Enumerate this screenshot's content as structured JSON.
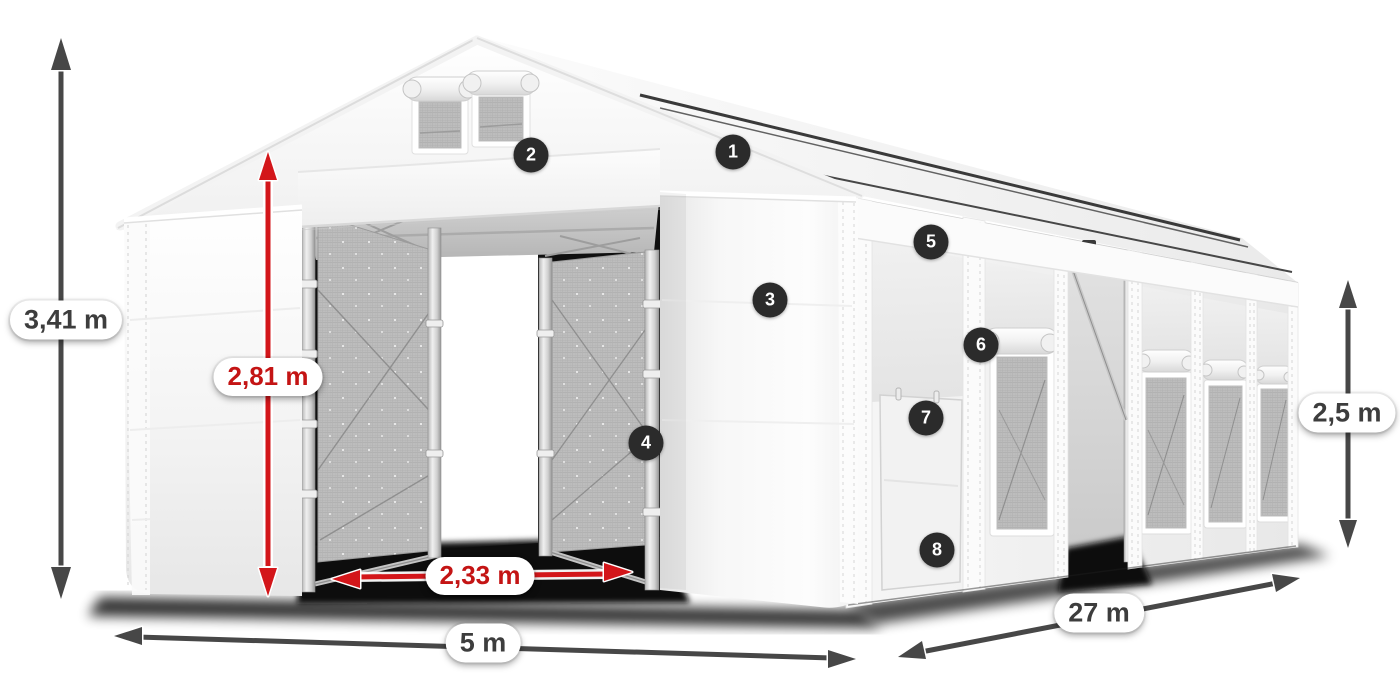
{
  "description": "Annotated product rendering of a white PVC storage tent (5 x 27 m) with open front gates, mesh side windows, a side entrance door, red and dark dimension arrows and eight numbered feature markers",
  "colors": {
    "background": "#ffffff",
    "arrow_dark": "#474747",
    "arrow_red": "#d3161a",
    "label_dark": "#3d3d3d",
    "label_red": "#c41414",
    "pill_bg": "#ffffff",
    "badge_bg": "#2b2b2b",
    "badge_text": "#ffffff",
    "tent_white": "#f7f7f7",
    "mesh_gray": "#bdbdbd",
    "interior_dark": "#101010"
  },
  "dimension_labels": {
    "total_height": "3,41 m",
    "door_height": "2,81 m",
    "door_width": "2,33 m",
    "front_width": "5 m",
    "side_length": "27 m",
    "side_wall_height": "2,5 m"
  },
  "feature_markers": [
    {
      "number": "1"
    },
    {
      "number": "2"
    },
    {
      "number": "3"
    },
    {
      "number": "4"
    },
    {
      "number": "5"
    },
    {
      "number": "6"
    },
    {
      "number": "7"
    },
    {
      "number": "8"
    }
  ]
}
